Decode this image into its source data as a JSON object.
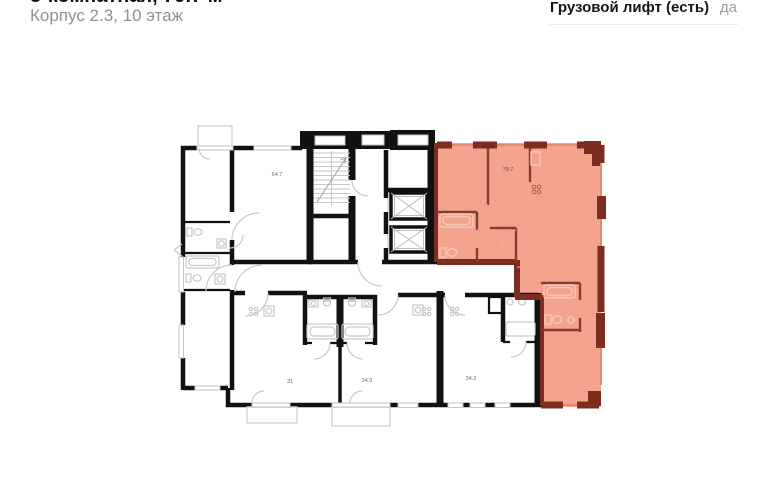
{
  "header": {
    "title": "3-комнатная, 79.7 м²",
    "subtitle": "Корпус 2.3, 10 этаж",
    "spec": {
      "label": "Грузовой лифт (есть)",
      "value": "да"
    }
  },
  "floor_plan": {
    "apartments": [
      {
        "area_label": "64.7",
        "highlighted": false
      },
      {
        "area_label": "79.7",
        "highlighted": true
      },
      {
        "area_label": "31",
        "highlighted": false
      },
      {
        "area_label": "34.9",
        "highlighted": false
      },
      {
        "area_label": "34.3",
        "highlighted": false
      }
    ],
    "colors": {
      "highlight_fill": "#f4a38f",
      "highlight_wall": "#7b2e1f",
      "wall": "#111111",
      "detail": "#c9c9c9"
    }
  }
}
